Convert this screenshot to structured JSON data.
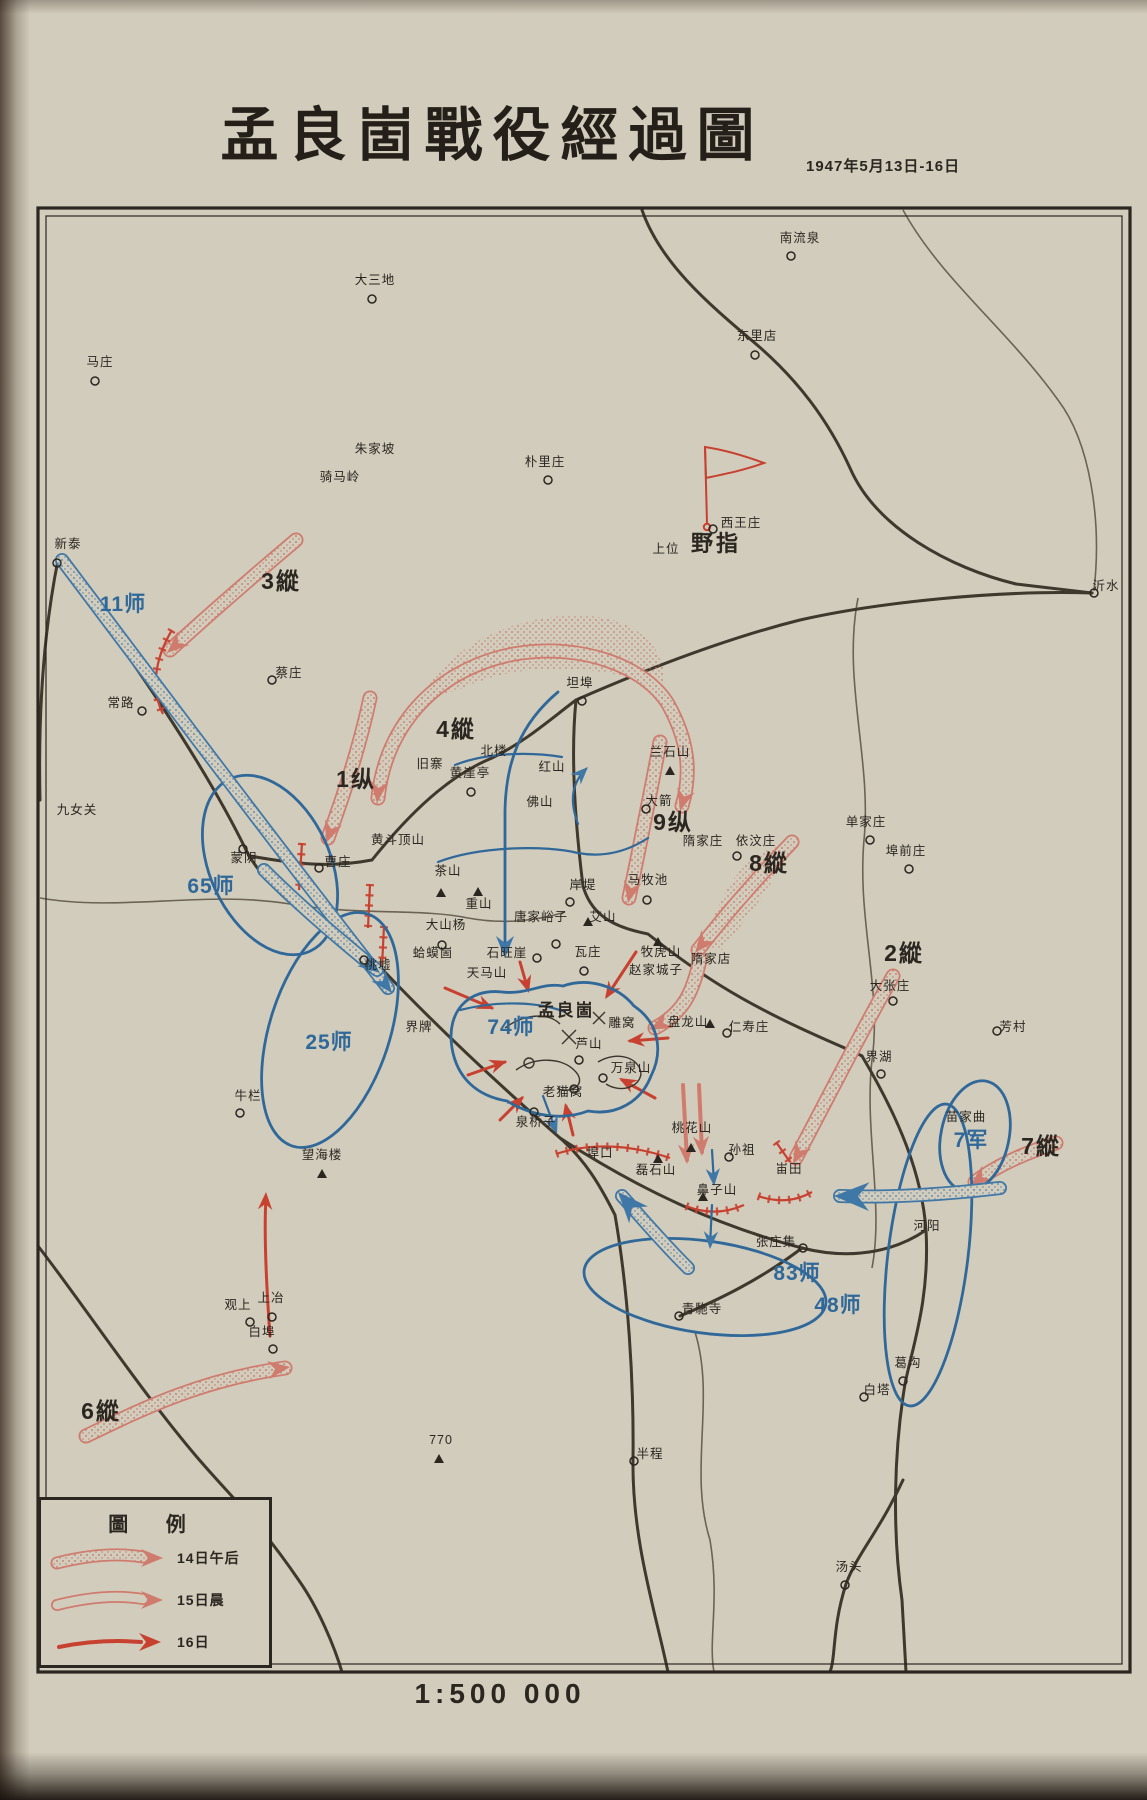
{
  "page": {
    "title": "孟良崮戰役經過圖",
    "date": "1947年5月13日-16日",
    "scale": "1:500 000"
  },
  "colors": {
    "paper": "#d2ccbc",
    "ink": "#2b2620",
    "blue_nationalist": "#2f6899",
    "red_communist": "#c8402f",
    "red_light": "#cf7b6d"
  },
  "legend": {
    "title": "圖  例",
    "items": [
      {
        "label": "14日午后",
        "style": "stippled-arrow"
      },
      {
        "label": "15日晨",
        "style": "outline-arrow"
      },
      {
        "label": "16日",
        "style": "solid-arrow"
      }
    ]
  },
  "map": {
    "hq": {
      "n": "野指",
      "x": 716,
      "y": 551
    },
    "pla_columns": [
      {
        "n": "3縱",
        "x": 281,
        "y": 589
      },
      {
        "n": "4縱",
        "x": 456,
        "y": 737
      },
      {
        "n": "1纵",
        "x": 356,
        "y": 787
      },
      {
        "n": "9纵",
        "x": 673,
        "y": 830
      },
      {
        "n": "8縱",
        "x": 769,
        "y": 871
      },
      {
        "n": "2縱",
        "x": 904,
        "y": 961
      },
      {
        "n": "7縱",
        "x": 1041,
        "y": 1154
      },
      {
        "n": "6縱",
        "x": 101,
        "y": 1419
      }
    ],
    "nationalist_units": [
      {
        "n": "11师",
        "x": 123,
        "y": 611
      },
      {
        "n": "65师",
        "x": 211,
        "y": 893
      },
      {
        "n": "74师",
        "x": 511,
        "y": 1034
      },
      {
        "n": "25师",
        "x": 329,
        "y": 1049
      },
      {
        "n": "83师",
        "x": 797,
        "y": 1280
      },
      {
        "n": "48师",
        "x": 838,
        "y": 1312
      },
      {
        "n": "7军",
        "x": 971,
        "y": 1147
      }
    ],
    "places": [
      {
        "n": "大三地",
        "x": 375,
        "y": 284,
        "m": "c",
        "mx": 372,
        "my": 299
      },
      {
        "n": "南流泉",
        "x": 800,
        "y": 242,
        "m": "c",
        "mx": 791,
        "my": 256
      },
      {
        "n": "东里店",
        "x": 757,
        "y": 340,
        "m": "c",
        "mx": 755,
        "my": 355
      },
      {
        "n": "马庄",
        "x": 100,
        "y": 366,
        "m": "c",
        "mx": 95,
        "my": 381
      },
      {
        "n": "朴里庄",
        "x": 545,
        "y": 466,
        "m": "c",
        "mx": 548,
        "my": 480
      },
      {
        "n": "西王庄",
        "x": 741,
        "y": 527,
        "m": "c",
        "mx": 713,
        "my": 529
      },
      {
        "n": "朱家坡",
        "x": 375,
        "y": 453
      },
      {
        "n": "骑马岭",
        "x": 340,
        "y": 481
      },
      {
        "n": "新泰",
        "x": 68,
        "y": 548,
        "m": "c",
        "mx": 57,
        "my": 563
      },
      {
        "n": "上位",
        "x": 666,
        "y": 553
      },
      {
        "n": "蔡庄",
        "x": 289,
        "y": 677,
        "m": "c",
        "mx": 272,
        "my": 680
      },
      {
        "n": "常路",
        "x": 121,
        "y": 707,
        "m": "c",
        "mx": 142,
        "my": 711
      },
      {
        "n": "沂水",
        "x": 1106,
        "y": 590,
        "m": "c",
        "mx": 1094,
        "my": 593
      },
      {
        "n": "坦埠",
        "x": 580,
        "y": 687,
        "m": "c",
        "mx": 582,
        "my": 701
      },
      {
        "n": "北楼",
        "x": 494,
        "y": 755
      },
      {
        "n": "旧寨",
        "x": 430,
        "y": 768
      },
      {
        "n": "黄崖亭",
        "x": 470,
        "y": 777,
        "m": "c",
        "mx": 471,
        "my": 792
      },
      {
        "n": "红山",
        "x": 552,
        "y": 771
      },
      {
        "n": "兰石山",
        "x": 670,
        "y": 756,
        "m": "t",
        "mx": 670,
        "my": 771
      },
      {
        "n": "佛山",
        "x": 540,
        "y": 806
      },
      {
        "n": "大箭",
        "x": 659,
        "y": 805,
        "m": "c",
        "mx": 646,
        "my": 809
      },
      {
        "n": "单家庄",
        "x": 866,
        "y": 826,
        "m": "c",
        "mx": 870,
        "my": 840
      },
      {
        "n": "埠前庄",
        "x": 906,
        "y": 855,
        "m": "c",
        "mx": 909,
        "my": 869
      },
      {
        "n": "蒙阴",
        "x": 244,
        "y": 862,
        "m": "c",
        "mx": 243,
        "my": 849
      },
      {
        "n": "曹庄",
        "x": 338,
        "y": 866,
        "m": "c",
        "mx": 319,
        "my": 868
      },
      {
        "n": "岸堤",
        "x": 583,
        "y": 889,
        "m": "c",
        "mx": 570,
        "my": 902
      },
      {
        "n": "艾山",
        "x": 603,
        "y": 921,
        "m": "t",
        "mx": 588,
        "my": 922
      },
      {
        "n": "马牧池",
        "x": 648,
        "y": 884,
        "m": "c",
        "mx": 647,
        "my": 900
      },
      {
        "n": "唐家峪子",
        "x": 541,
        "y": 921,
        "m": "c",
        "mx": 556,
        "my": 944
      },
      {
        "n": "重山",
        "x": 479,
        "y": 908,
        "m": "t",
        "mx": 478,
        "my": 892
      },
      {
        "n": "黄斗顶山",
        "x": 398,
        "y": 844
      },
      {
        "n": "茶山",
        "x": 448,
        "y": 875,
        "m": "t",
        "mx": 441,
        "my": 893
      },
      {
        "n": "大山杨",
        "x": 446,
        "y": 929,
        "m": "c",
        "mx": 442,
        "my": 945
      },
      {
        "n": "蛤蟆崮",
        "x": 433,
        "y": 957
      },
      {
        "n": "石旺崖",
        "x": 507,
        "y": 957,
        "m": "c",
        "mx": 537,
        "my": 958
      },
      {
        "n": "瓦庄",
        "x": 588,
        "y": 956,
        "m": "c",
        "mx": 584,
        "my": 971
      },
      {
        "n": "牧虎山",
        "x": 661,
        "y": 956,
        "m": "t",
        "mx": 658,
        "my": 942
      },
      {
        "n": "赵家城子",
        "x": 656,
        "y": 974
      },
      {
        "n": "隋家庄",
        "x": 703,
        "y": 845
      },
      {
        "n": "依汶庄",
        "x": 756,
        "y": 845,
        "m": "c",
        "mx": 737,
        "my": 856
      },
      {
        "n": "隋家店",
        "x": 711,
        "y": 963
      },
      {
        "n": "天马山",
        "x": 487,
        "y": 977
      },
      {
        "n": "孟良崮",
        "x": 566,
        "y": 1016,
        "s": "lg"
      },
      {
        "n": "雕窝",
        "x": 622,
        "y": 1027
      },
      {
        "n": "芦山",
        "x": 589,
        "y": 1048,
        "m": "c",
        "mx": 579,
        "my": 1060
      },
      {
        "n": "万泉山",
        "x": 631,
        "y": 1072,
        "m": "c",
        "mx": 603,
        "my": 1078
      },
      {
        "n": "盘龙山",
        "x": 688,
        "y": 1026,
        "m": "t",
        "mx": 710,
        "my": 1024
      },
      {
        "n": "仁寿庄",
        "x": 749,
        "y": 1031,
        "m": "c",
        "mx": 727,
        "my": 1033
      },
      {
        "n": "老猫窝",
        "x": 563,
        "y": 1096,
        "m": "c",
        "mx": 574,
        "my": 1089
      },
      {
        "n": "埠口",
        "x": 600,
        "y": 1157
      },
      {
        "n": "泉桥子",
        "x": 536,
        "y": 1126,
        "m": "c",
        "mx": 534,
        "my": 1112
      },
      {
        "n": "界牌",
        "x": 419,
        "y": 1031
      },
      {
        "n": "桃墟",
        "x": 378,
        "y": 969,
        "m": "c",
        "mx": 364,
        "my": 960
      },
      {
        "n": "九女关",
        "x": 77,
        "y": 814
      },
      {
        "n": "牛栏",
        "x": 248,
        "y": 1100,
        "m": "c",
        "mx": 240,
        "my": 1113
      },
      {
        "n": "望海楼",
        "x": 322,
        "y": 1159,
        "m": "t",
        "mx": 322,
        "my": 1174
      },
      {
        "n": "桃花山",
        "x": 692,
        "y": 1132,
        "m": "t",
        "mx": 691,
        "my": 1148
      },
      {
        "n": "孙祖",
        "x": 742,
        "y": 1154,
        "m": "c",
        "mx": 729,
        "my": 1157
      },
      {
        "n": "磊石山",
        "x": 656,
        "y": 1174,
        "m": "t",
        "mx": 658,
        "my": 1159
      },
      {
        "n": "鼻子山",
        "x": 717,
        "y": 1194,
        "m": "t",
        "mx": 703,
        "my": 1197
      },
      {
        "n": "峀田",
        "x": 789,
        "y": 1173
      },
      {
        "n": "张庄集",
        "x": 776,
        "y": 1246,
        "m": "c",
        "mx": 803,
        "my": 1248
      },
      {
        "n": "界湖",
        "x": 879,
        "y": 1061,
        "m": "c",
        "mx": 881,
        "my": 1074
      },
      {
        "n": "大张庄",
        "x": 890,
        "y": 990,
        "m": "c",
        "mx": 893,
        "my": 1001
      },
      {
        "n": "芳村",
        "x": 1013,
        "y": 1031,
        "m": "c",
        "mx": 997,
        "my": 1031
      },
      {
        "n": "苗家曲",
        "x": 966,
        "y": 1121
      },
      {
        "n": "河阳",
        "x": 927,
        "y": 1230
      },
      {
        "n": "青駞寺",
        "x": 702,
        "y": 1313,
        "m": "c",
        "mx": 679,
        "my": 1316
      },
      {
        "n": "葛沟",
        "x": 908,
        "y": 1367,
        "m": "c",
        "mx": 903,
        "my": 1381
      },
      {
        "n": "白塔",
        "x": 877,
        "y": 1394,
        "m": "c",
        "mx": 864,
        "my": 1397
      },
      {
        "n": "半程",
        "x": 650,
        "y": 1458,
        "m": "c",
        "mx": 634,
        "my": 1461
      },
      {
        "n": "汤头",
        "x": 849,
        "y": 1571,
        "m": "c",
        "mx": 845,
        "my": 1585
      },
      {
        "n": "費县",
        "x": 252,
        "y": 1524,
        "m": "c",
        "mx": 238,
        "my": 1538
      },
      {
        "n": "上冶",
        "x": 271,
        "y": 1302,
        "m": "c",
        "mx": 272,
        "my": 1317
      },
      {
        "n": "观上",
        "x": 238,
        "y": 1309,
        "m": "c",
        "mx": 250,
        "my": 1322
      },
      {
        "n": "白埠",
        "x": 262,
        "y": 1336,
        "m": "c",
        "mx": 273,
        "my": 1349
      },
      {
        "n": "770",
        "x": 441,
        "y": 1444,
        "m": "t",
        "mx": 439,
        "my": 1459
      }
    ]
  }
}
